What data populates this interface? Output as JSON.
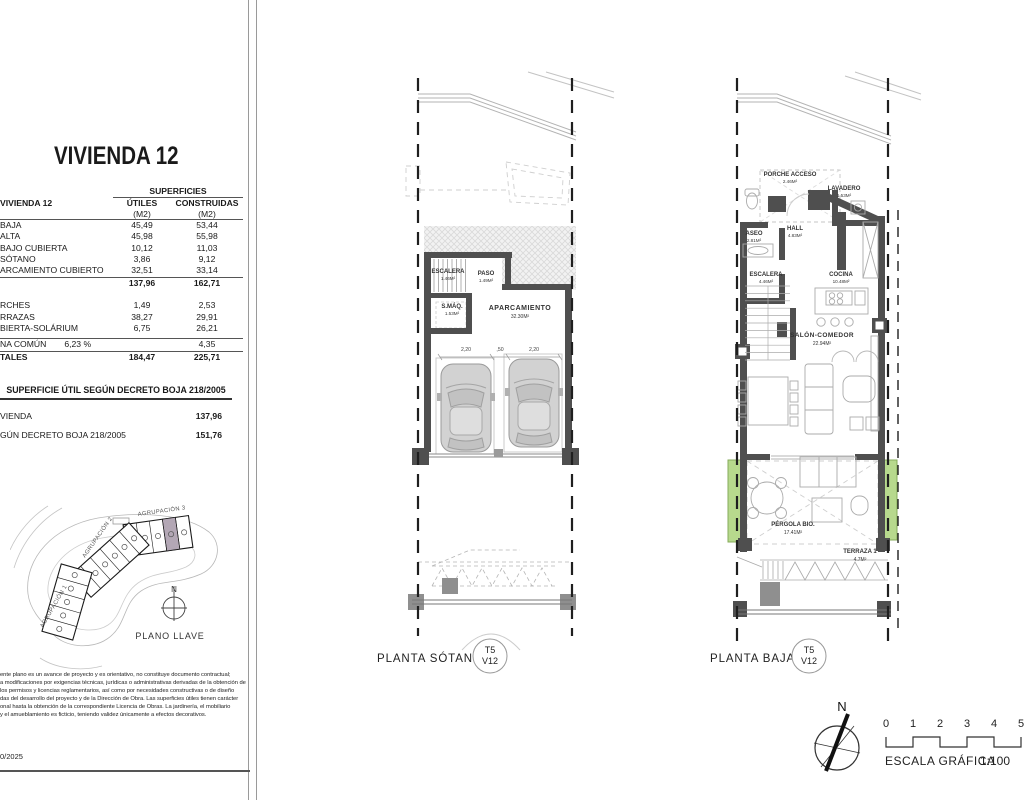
{
  "colors": {
    "wall": "#4f4f4f",
    "car_body": "#d2d2d2",
    "green_planter": "#b7d98d",
    "highlight_unit": "#b3a7b5",
    "post_gray": "#8f8f8f",
    "hatch_line": "#d9d9d9"
  },
  "left_panel": {
    "title": "VIVIENDA 12",
    "table": {
      "unit_label": "VIVIENDA 12",
      "group_header": "SUPERFICIES",
      "col_utiles": "ÚTILES",
      "col_construidas": "CONSTRUIDAS",
      "col_unit": "(M2)",
      "rows": [
        {
          "label": "BAJA",
          "utiles": "45,49",
          "construidas": "53,44"
        },
        {
          "label": "ALTA",
          "utiles": "45,98",
          "construidas": "55,98"
        },
        {
          "label": "BAJO CUBIERTA",
          "utiles": "10,12",
          "construidas": "11,03"
        },
        {
          "label": "SÓTANO",
          "utiles": "3,86",
          "construidas": "9,12"
        },
        {
          "label": "ARCAMIENTO CUBIERTO",
          "utiles": "32,51",
          "construidas": "33,14"
        }
      ],
      "subtotal": {
        "utiles": "137,96",
        "construidas": "162,71"
      },
      "rows2": [
        {
          "label": "RCHES",
          "utiles": "1,49",
          "construidas": "2,53"
        },
        {
          "label": "RRAZAS",
          "utiles": "38,27",
          "construidas": "29,91"
        },
        {
          "label": "BIERTA-SOLÁRIUM",
          "utiles": "6,75",
          "construidas": "26,21"
        }
      ],
      "common_row": {
        "label": "NA COMÚN",
        "pct": "6,23 %",
        "construidas": "4,35"
      },
      "total_row": {
        "label": "TALES",
        "utiles": "184,47",
        "construidas": "225,71"
      }
    },
    "decreto": {
      "header": "SUPERFICIE ÚTIL SEGÚN DECRETO BOJA 218/2005",
      "rows": [
        {
          "label": "VIENDA",
          "value": "137,96"
        },
        {
          "label": "GÚN DECRETO BOJA 218/2005",
          "value": "151,76"
        }
      ]
    },
    "key_plan": {
      "labels": {
        "g1": "AGRUPACIÓN 1",
        "g2": "AGRUPACIÓN 2",
        "g3": "AGRUPACIÓN 3"
      },
      "north": "N",
      "caption": "PLANO LLAVE"
    },
    "disclaimer": [
      "ente plano es un avance de proyecto y es orientativo, no constituye documento contractual;",
      "a modificaciones por exigencias técnicas, jurídicas o administrativas derivadas de la obtención de",
      "los permisos y licencias reglamentarios, así como por necesidades constructivas o de diseño",
      "das del desarrollo del proyecto y de la Dirección de Obra. Las superficies útiles tienen carácter",
      "onal hasta la obtención de la correspondiente Licencia de Obras. La jardinería, el mobiliario",
      "y el amueblamiento es ficticio, teniendo validez únicamente a efectos decorativos."
    ],
    "date": "0/2025"
  },
  "sotano": {
    "caption": "PLANTA SÓTANO",
    "badge": {
      "line1": "T5",
      "line2": "V12"
    },
    "rooms": {
      "escalera": {
        "name": "ESCALERA",
        "area": "1.46M²"
      },
      "paso": {
        "name": "PASO",
        "area": "1.49M²"
      },
      "smaq": {
        "name": "S.MÁQ.",
        "area": "1.53M²"
      },
      "aparcamiento": {
        "name": "APARCAMIENTO",
        "area": "32.30M²"
      }
    },
    "dims": {
      "bay1": "2,20",
      "pier": ",50",
      "bay2": "2,20"
    }
  },
  "baja": {
    "caption": "PLANTA BAJA",
    "badge": {
      "line1": "T5",
      "line2": "V12"
    },
    "rooms": {
      "porche": {
        "name": "PORCHE ACCESO",
        "area": "2.46M²"
      },
      "lavadero": {
        "name": "LAVADERO",
        "area": "1.53M²"
      },
      "aseo": {
        "name": "ASEO",
        "area": "2.81M²"
      },
      "hall": {
        "name": "HALL",
        "area": "4.83M²"
      },
      "escalera": {
        "name": "ESCALERA",
        "area": "4.46M²"
      },
      "cocina": {
        "name": "COCINA",
        "area": "10.48M²"
      },
      "salon": {
        "name": "SALÓN-COMEDOR",
        "area": "22.94M²"
      },
      "pergola": {
        "name": "PÉRGOLA BIO.",
        "area": "17.41M²"
      },
      "terraza": {
        "name": "TERRAZA 1",
        "area": "4.7M²"
      }
    }
  },
  "footer": {
    "north": "N",
    "scale_ticks": [
      "0",
      "1",
      "2",
      "3",
      "4",
      "5"
    ],
    "scale_label": "ESCALA GRÁFICA",
    "scale_ratio": "1:100"
  }
}
